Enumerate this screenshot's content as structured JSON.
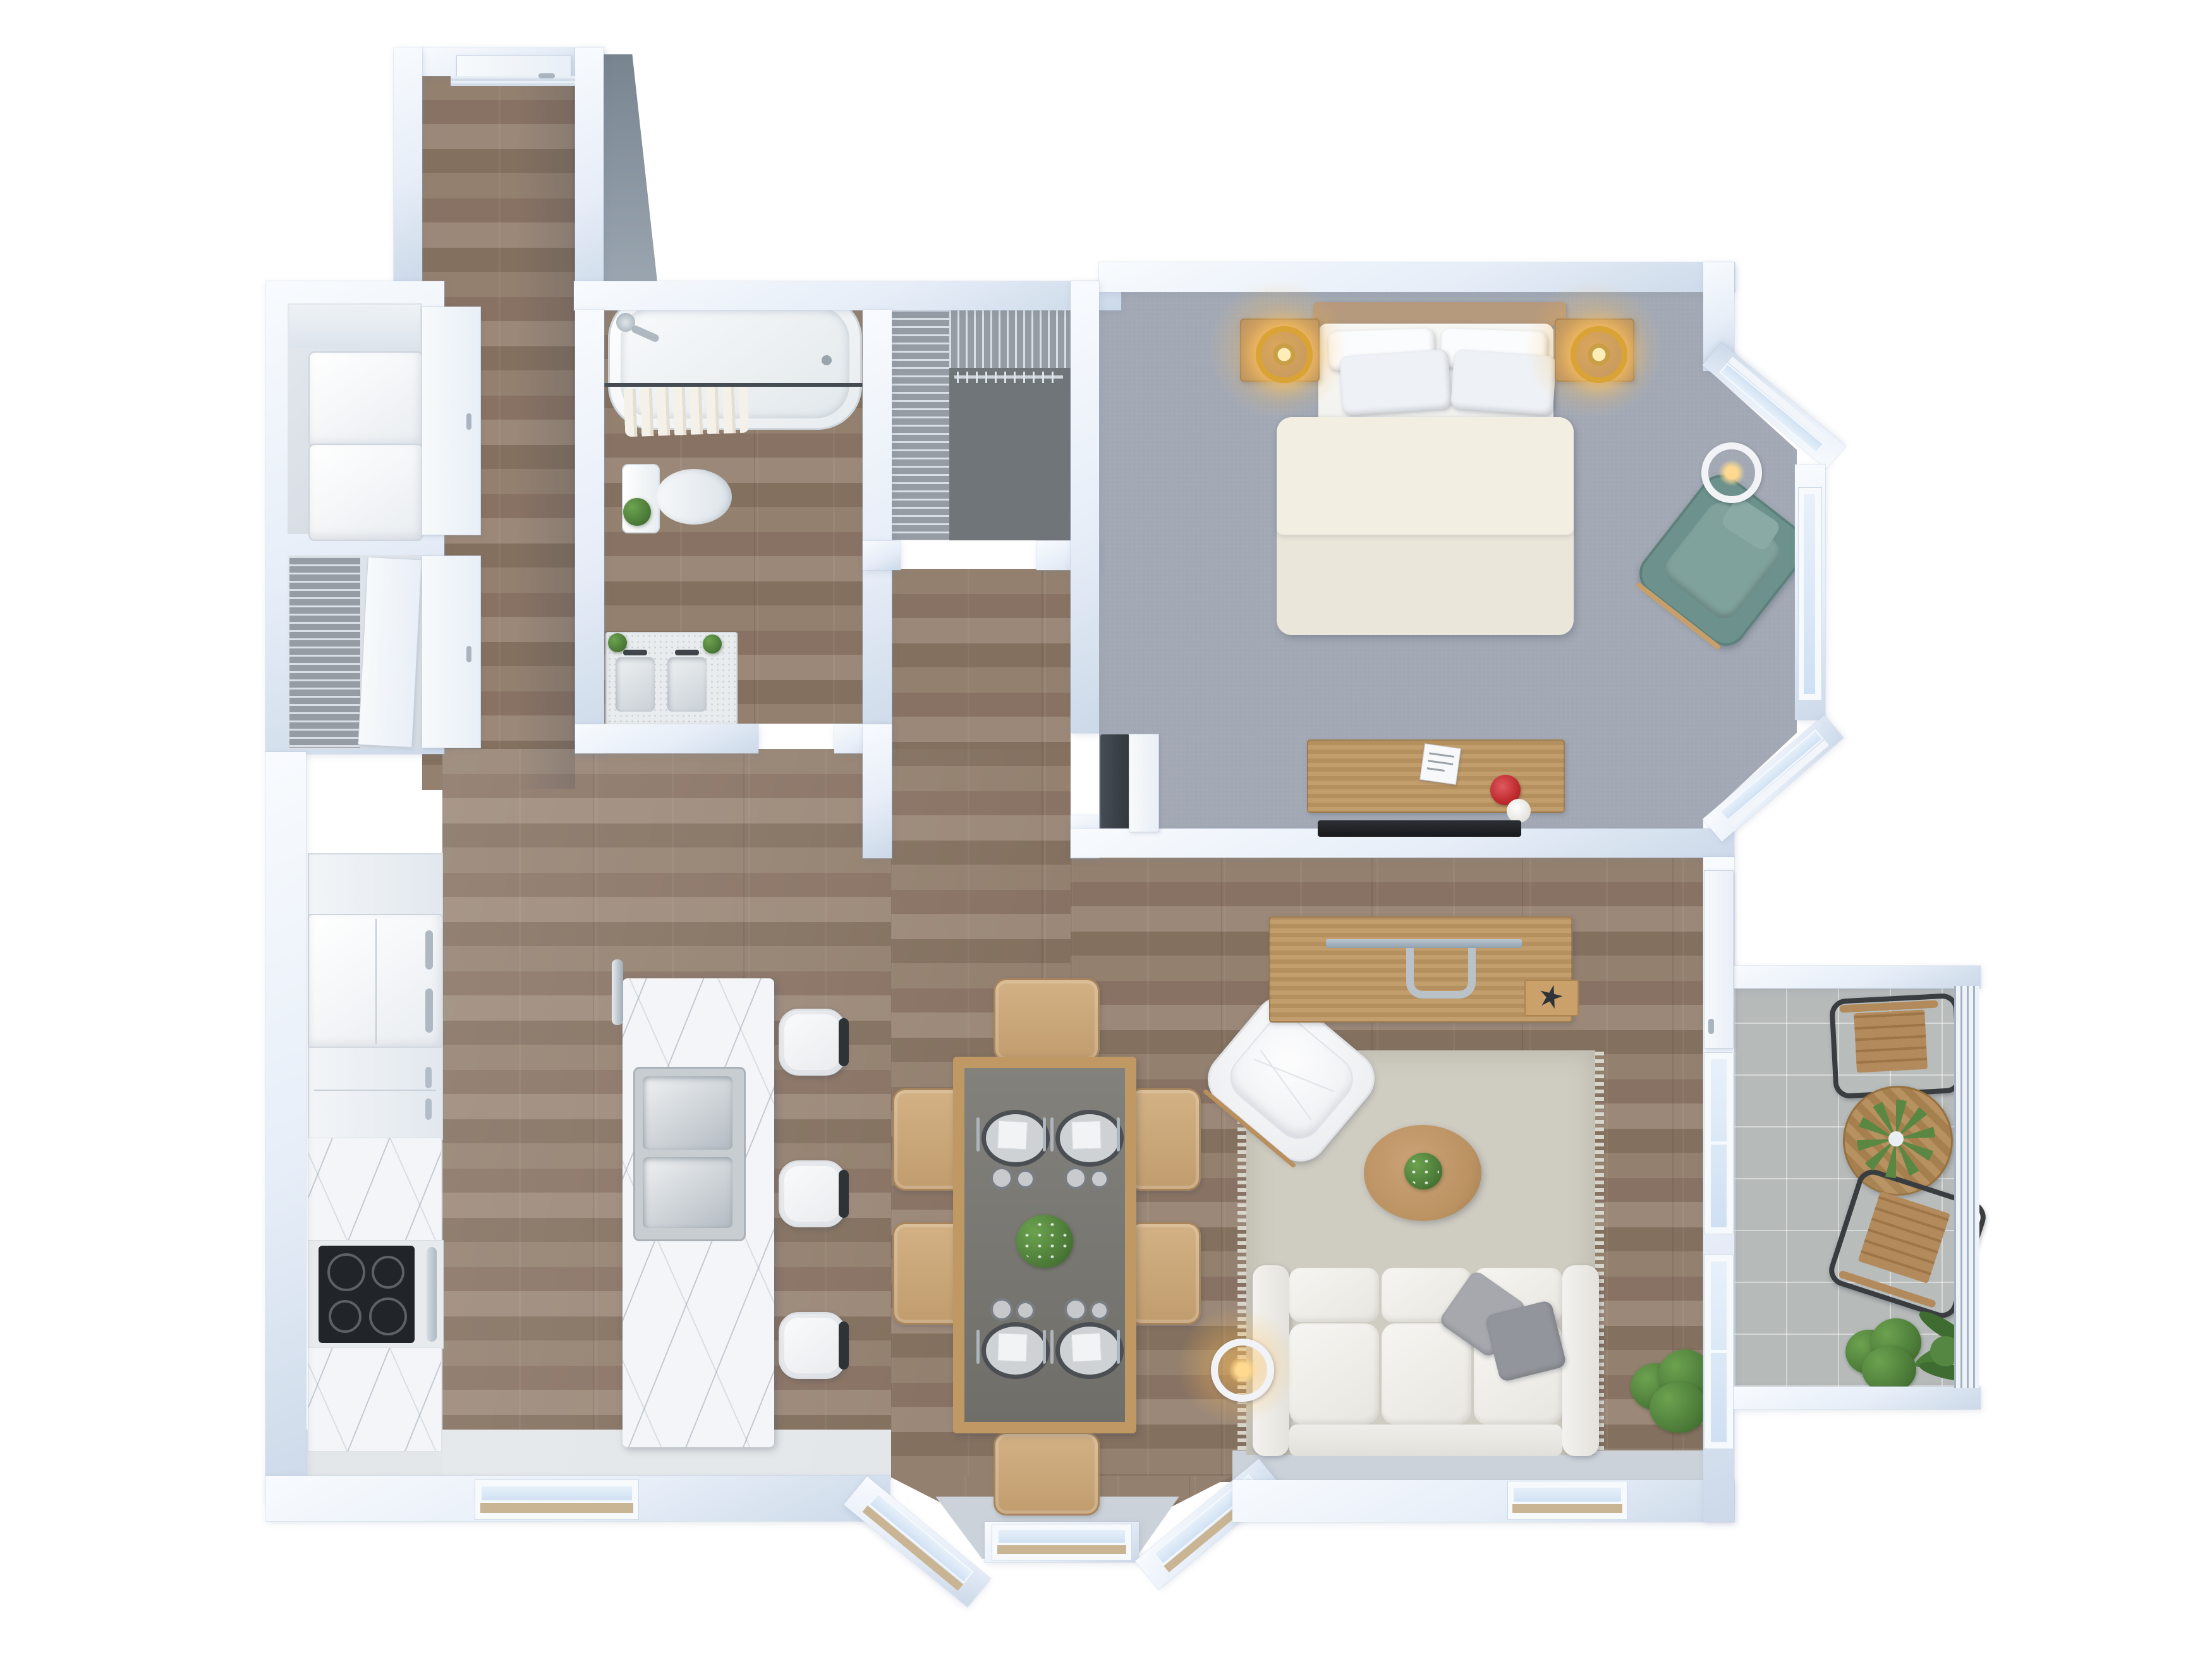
{
  "meta": {
    "title": "Apartment Floor Plan — 3D Top-Down Render",
    "view": "top-down",
    "style": "photorealistic 3D floor plan, no text labels"
  },
  "colors": {
    "wall": "#e7eef8",
    "wallBright": "#f8fbfe",
    "wallShade": "#ccd9e9",
    "wood": "#8d7868",
    "carpet": "#a3a9b4",
    "carpetDark": "#70757a",
    "tile": "#b6bab9",
    "kitchenFloor": "#e3e7ea",
    "paleFloor": "#ccd2d9",
    "glass": "#cfe0f3",
    "glassBright": "#e8f1fa",
    "sill": "#c9b493",
    "marble": "#f3f5f8",
    "furnWood": "#bf9864",
    "nightWood": "#b18e66",
    "teal": "#6d928d",
    "tealLight": "#80a29d",
    "red": "#bf2a2e",
    "sofa": "#f0efeb",
    "rug": "#cfccc1",
    "plant": "#4d7c39",
    "plantLight": "#6ca24f",
    "lampAmber": "#daa336",
    "dark": "#30353a"
  },
  "rooms": [
    {
      "name": "Entry Hall",
      "furniture": [
        "entry door",
        "hardwood floor"
      ]
    },
    {
      "name": "Laundry Closets",
      "furniture": [
        "stacked washer",
        "stacked dryer",
        "wire shelving",
        "two closet doors"
      ]
    },
    {
      "name": "Bathroom",
      "furniture": [
        "bathtub with faucet",
        "shower rail with hanging towels",
        "toilet with plant",
        "double-sink vanity",
        "two small plants"
      ]
    },
    {
      "name": "Walk-in Closet",
      "furniture": [
        "wire shelving on two walls",
        "hanger rail",
        "gray carpet"
      ]
    },
    {
      "name": "Bedroom",
      "furniture": [
        "double bed with 4 pillows and cream duvet",
        "wood headboard",
        "2 nightstands",
        "2 glowing ring lamps",
        "white floor lamp",
        "teal accent armchair",
        "wood desk with red bowl and white bowl and paper",
        "wall-mounted TV",
        "dark cabinet",
        "white door",
        "bay with 3 windows"
      ]
    },
    {
      "name": "Kitchen",
      "furniture": [
        "tall cabinet",
        "fridge with twin handles",
        "drawer cabinet",
        "marble counter",
        "black cooktop with 4 burners",
        "oven handle",
        "marble counter",
        "marble island",
        "double stainless sink",
        "island faucet",
        "3 white bar stools"
      ]
    },
    {
      "name": "Dining Area",
      "furniture": [
        "wood dining table with gray top",
        "6 tan chairs",
        "4 place settings with charger plates and glasses",
        "green centerpiece"
      ]
    },
    {
      "name": "Living Room",
      "furniture": [
        "white 3-seat sofa",
        "2 gray throw pillows",
        "beige fringed rug",
        "oval wood coffee table with plant",
        "white tufted lounge chair",
        "glowing floor lamp",
        "potted plant",
        "wood console desk",
        "monitor",
        "tray with dark star plant"
      ]
    },
    {
      "name": "Balcony",
      "furniture": [
        "2 black-frame wood-slat chairs",
        "round wood bistro table",
        "agave plant",
        "2 potted plants",
        "vertical-bar railing",
        "tiled floor"
      ]
    }
  ],
  "counts": {
    "bed_pillows": 4,
    "sofa_throw_pillows": 2,
    "dining_chairs": 6,
    "place_settings": 4,
    "bar_stools": 3,
    "balcony_chairs": 2,
    "nightstand_lamps": 2,
    "bedroom_bay_windows": 3,
    "south_bay_windows": 3,
    "balcony_facing_windows": 2
  }
}
